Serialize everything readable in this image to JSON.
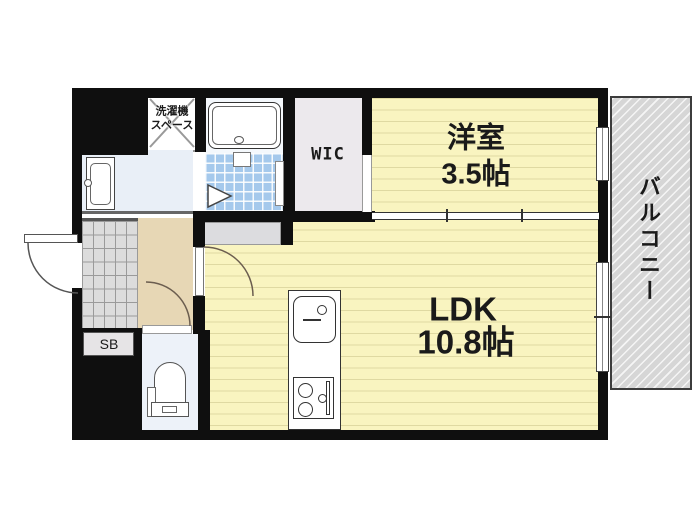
{
  "plan": {
    "rooms": {
      "western_room": {
        "name": "洋室",
        "size": "3.5帖"
      },
      "ldk": {
        "name": "LDK",
        "size": "10.8帖"
      },
      "wic": {
        "label": "WIC"
      },
      "laundry_space": {
        "line1": "洗濯機",
        "line2": "スペース"
      },
      "shoe_box": {
        "label": "SB"
      },
      "balcony": {
        "label": "バルコニー"
      }
    },
    "fixtures": [
      "bathtub",
      "bathroom-folding-door",
      "vanity-basin",
      "kitchen-sink",
      "gas-stove",
      "toilet",
      "entrance-door-swing",
      "interior-door-swings",
      "sliding-partition",
      "windows",
      "entrance-tile",
      "laundry-cross"
    ],
    "colors": {
      "wall": "#0f0f0f",
      "room_yellow": "#f9f4c0",
      "hall_beige": "#e7d7b5",
      "bath_tile_blue": "#a5c9ec",
      "balcony_grey": "#d6d6d6",
      "washroom_blue": "#e9eff7",
      "toilet_floor": "#edf2f9",
      "wic_grey": "#ece9ed",
      "entrance_tile_grey": "#dcdcdc"
    }
  }
}
